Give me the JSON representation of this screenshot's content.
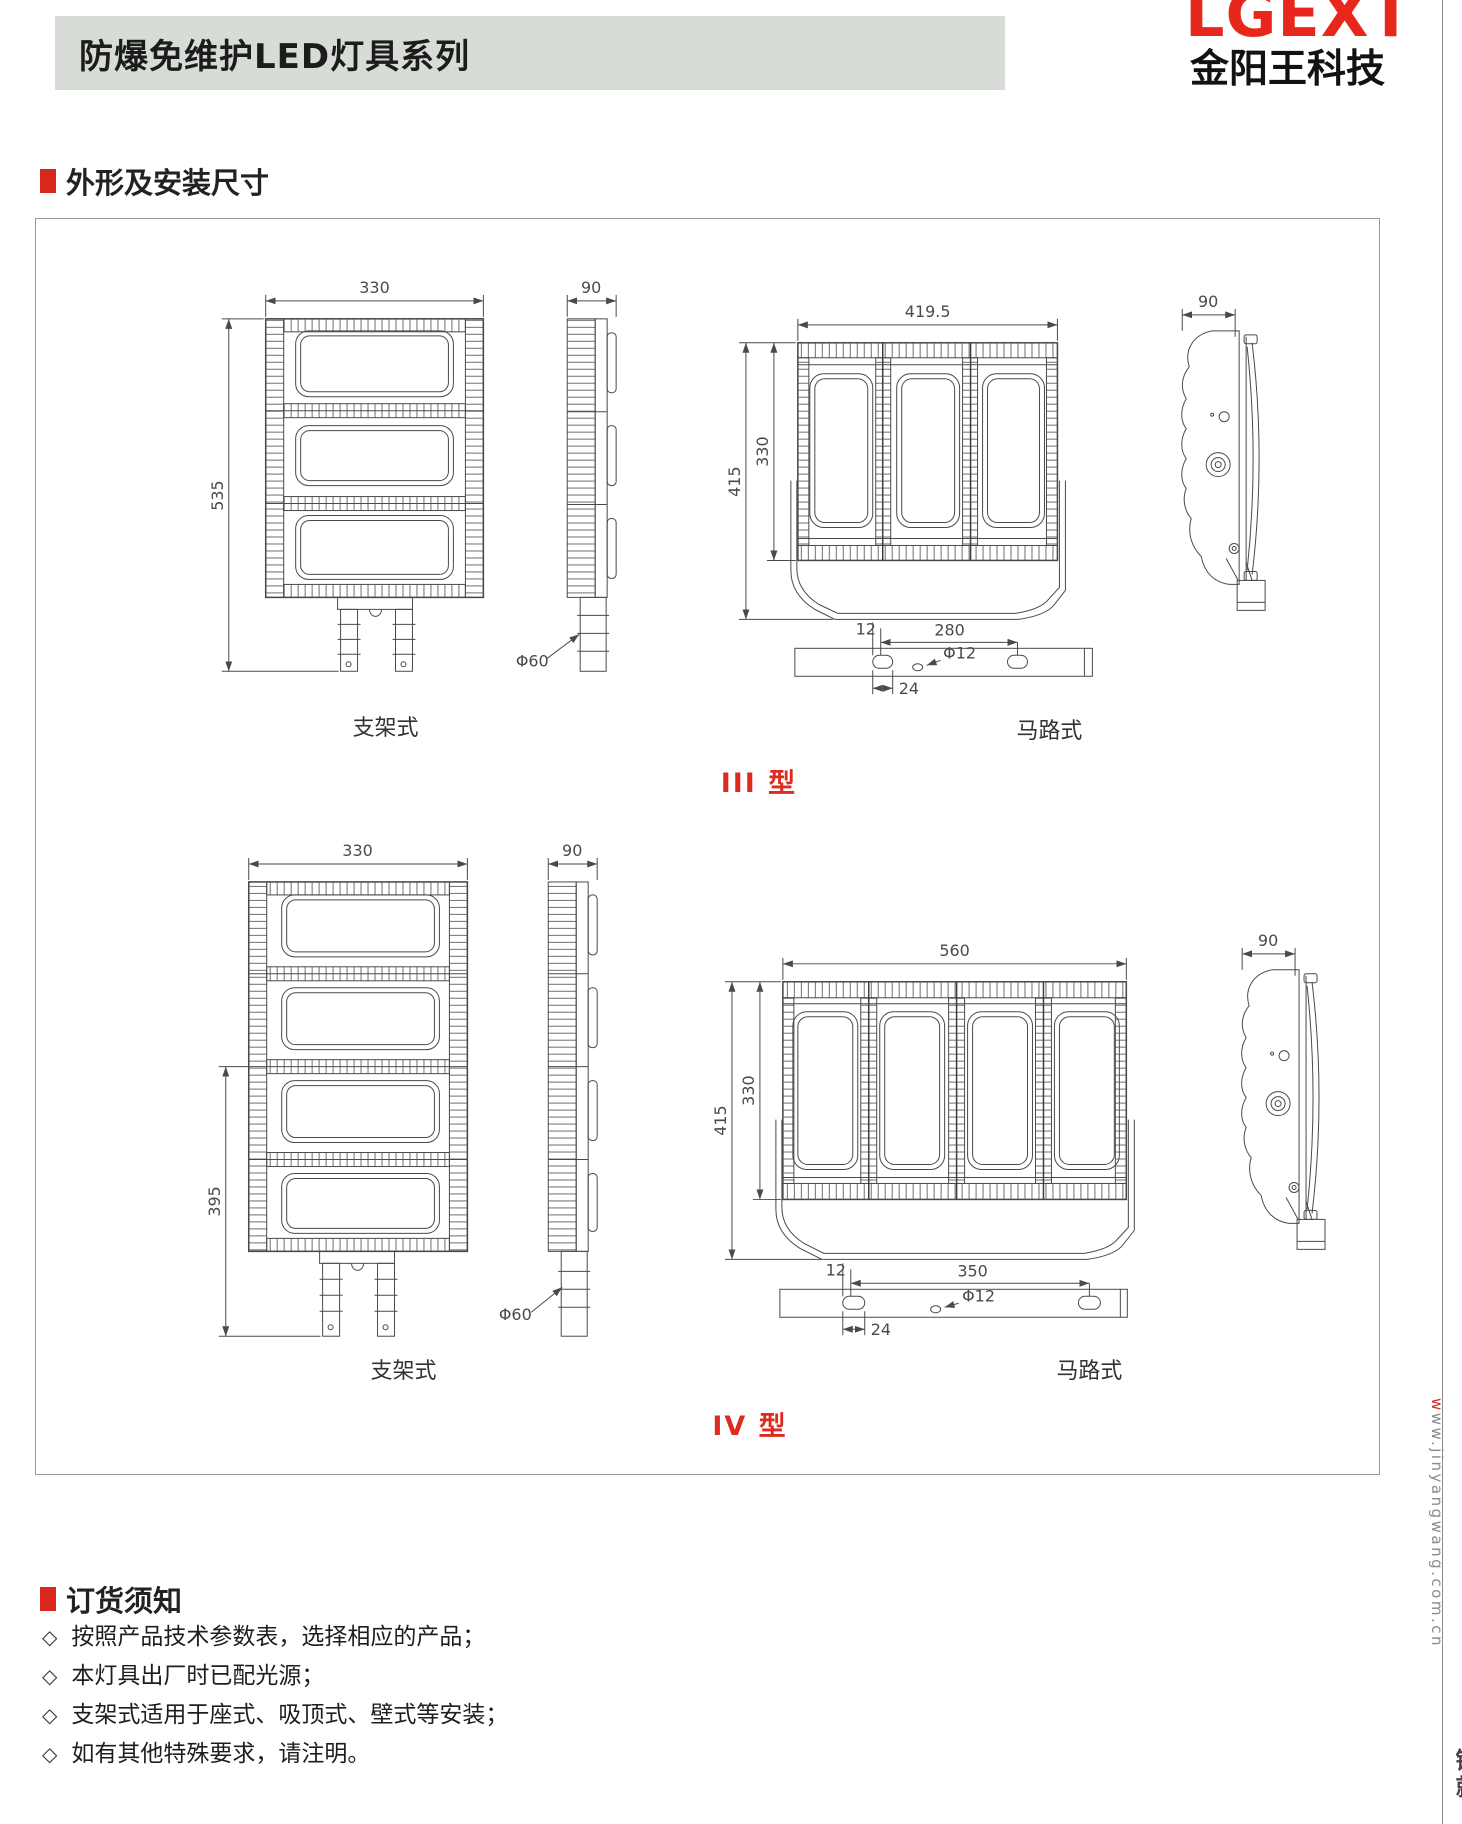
{
  "header": {
    "title": "防爆免维护LED灯具系列",
    "logo_main": "LGEXT",
    "logo_sub": "金阳王科技"
  },
  "section1": {
    "title": "外形及安装尺寸"
  },
  "section2": {
    "title": "订货须知"
  },
  "ui": {
    "bullet": "◇"
  },
  "ordering_notes": [
    "按照产品技术参数表，选择相应的产品；",
    "本灯具出厂时已配光源；",
    "支架式适用于座式、吸顶式、壁式等安装；",
    "如有其他特殊要求，请注明。"
  ],
  "type3": {
    "label": "III 型",
    "bracket_label": "支架式",
    "road_label": "马路式",
    "front_width": "330",
    "front_height": "535",
    "side_width": "90",
    "pole_dia": "Φ60",
    "road_width": "419.5",
    "road_height_outer": "415",
    "road_height_inner": "330",
    "road_side_width": "90",
    "plate_edge": "12",
    "plate_span": "280",
    "plate_hole_dia": "Φ12",
    "plate_slot": "24"
  },
  "type4": {
    "label": "IV 型",
    "bracket_label": "支架式",
    "road_label": "马路式",
    "front_width": "330",
    "front_height": "395",
    "side_width": "90",
    "pole_dia": "Φ60",
    "road_width": "560",
    "road_height_outer": "415",
    "road_height_inner": "330",
    "road_side_width": "90",
    "plate_edge": "12",
    "plate_span": "350",
    "plate_hole_dia": "Φ12",
    "plate_slot": "24"
  },
  "watermark": {
    "url_red": "w",
    "url_gray": "ww.jinyangwang.com.cn",
    "tail": "铸就"
  },
  "colors": {
    "accent_red": "#d7281d",
    "logo_red": "#e8271c",
    "type_label_red": "#dd2b20",
    "header_bar_bg": "#d7ddd6",
    "line_gray": "#4a4a4a"
  }
}
